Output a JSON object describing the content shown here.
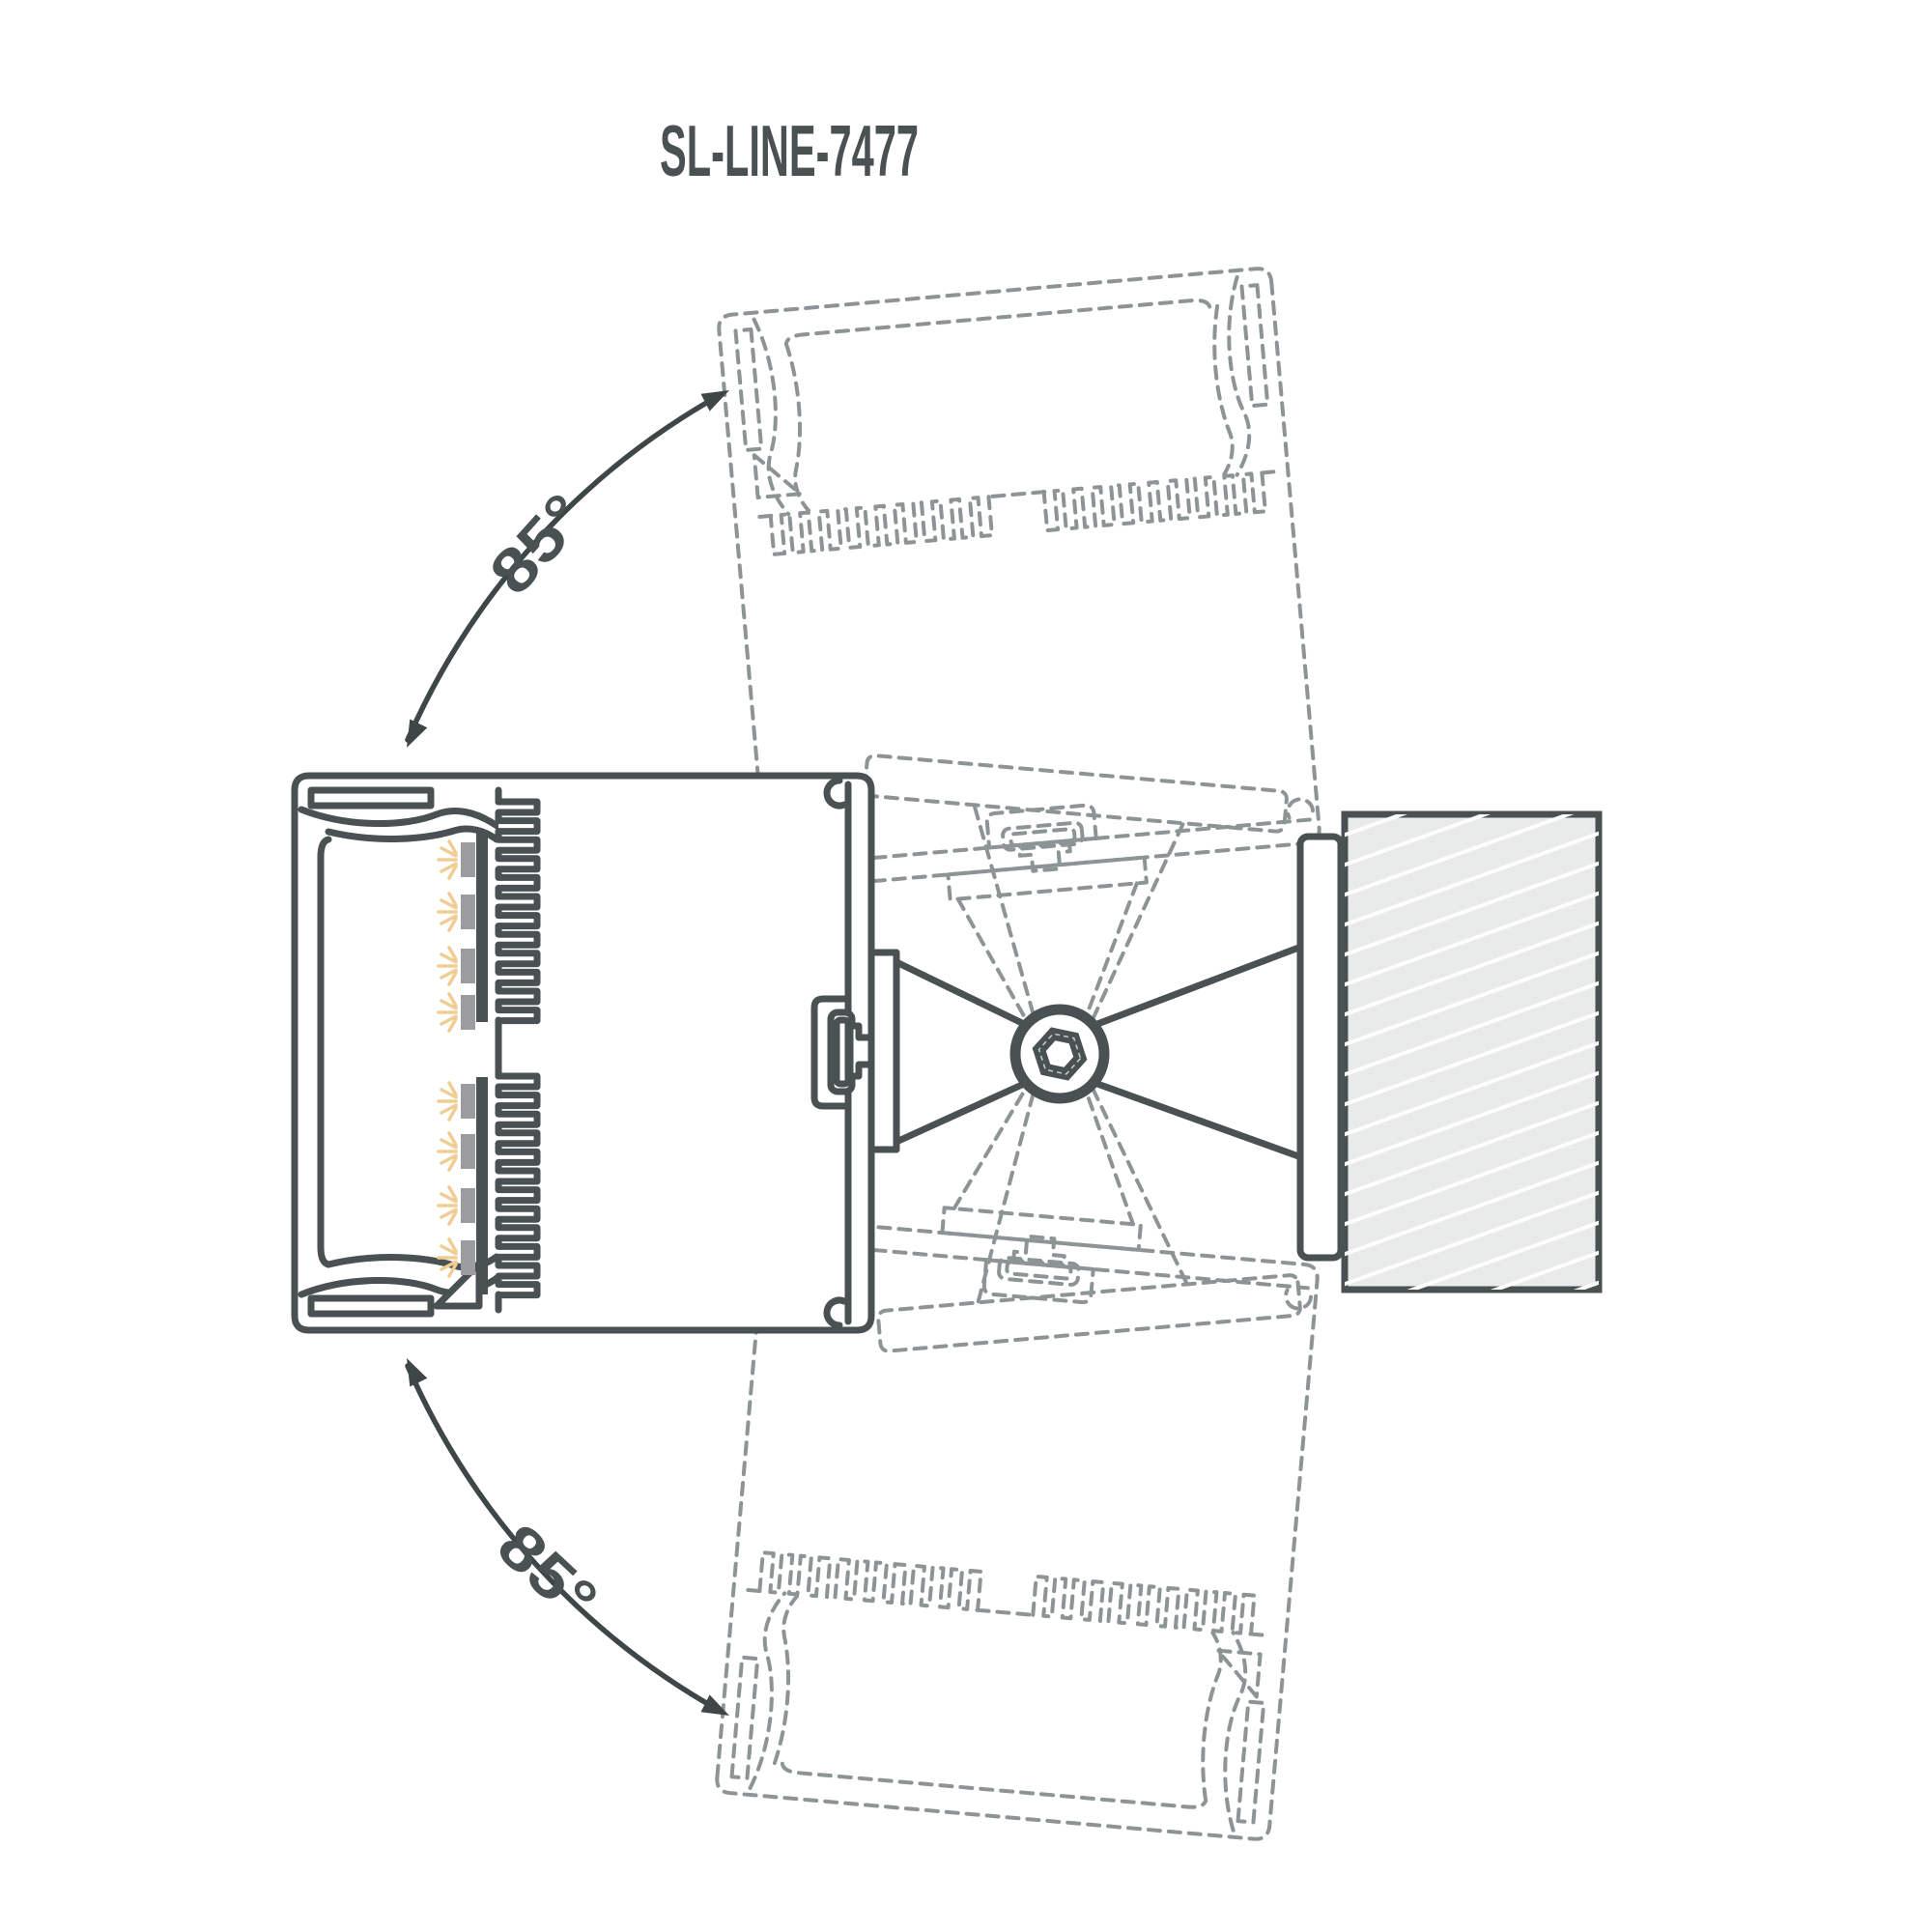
{
  "title": "SL-LINE-7477",
  "rotation": {
    "upper_angle_label": "85°",
    "lower_angle_label": "85°",
    "angle_degrees": 85,
    "pivot": "hex-socket-screw"
  },
  "components": {
    "fixture": "linear LED luminaire cross-section",
    "lens": "diffuser lens cover",
    "led_banks": 2,
    "leds_per_bank": 4,
    "heatsink_fins_per_bank": 12,
    "bracket": "pivot mounting bracket",
    "screw": "hex socket screw",
    "wall": "mounting wall (hatched)"
  },
  "colors": {
    "background": "#ffffff",
    "line": "#4a5152",
    "ghost_line": "#8d9495",
    "arrow": "#3f4648",
    "text": "#4a5152",
    "wall_fill": "#e9eaea",
    "wall_hatch": "#fdfdfd",
    "led_module": "#9c9ca0",
    "led_glow": "#f0cd92"
  }
}
